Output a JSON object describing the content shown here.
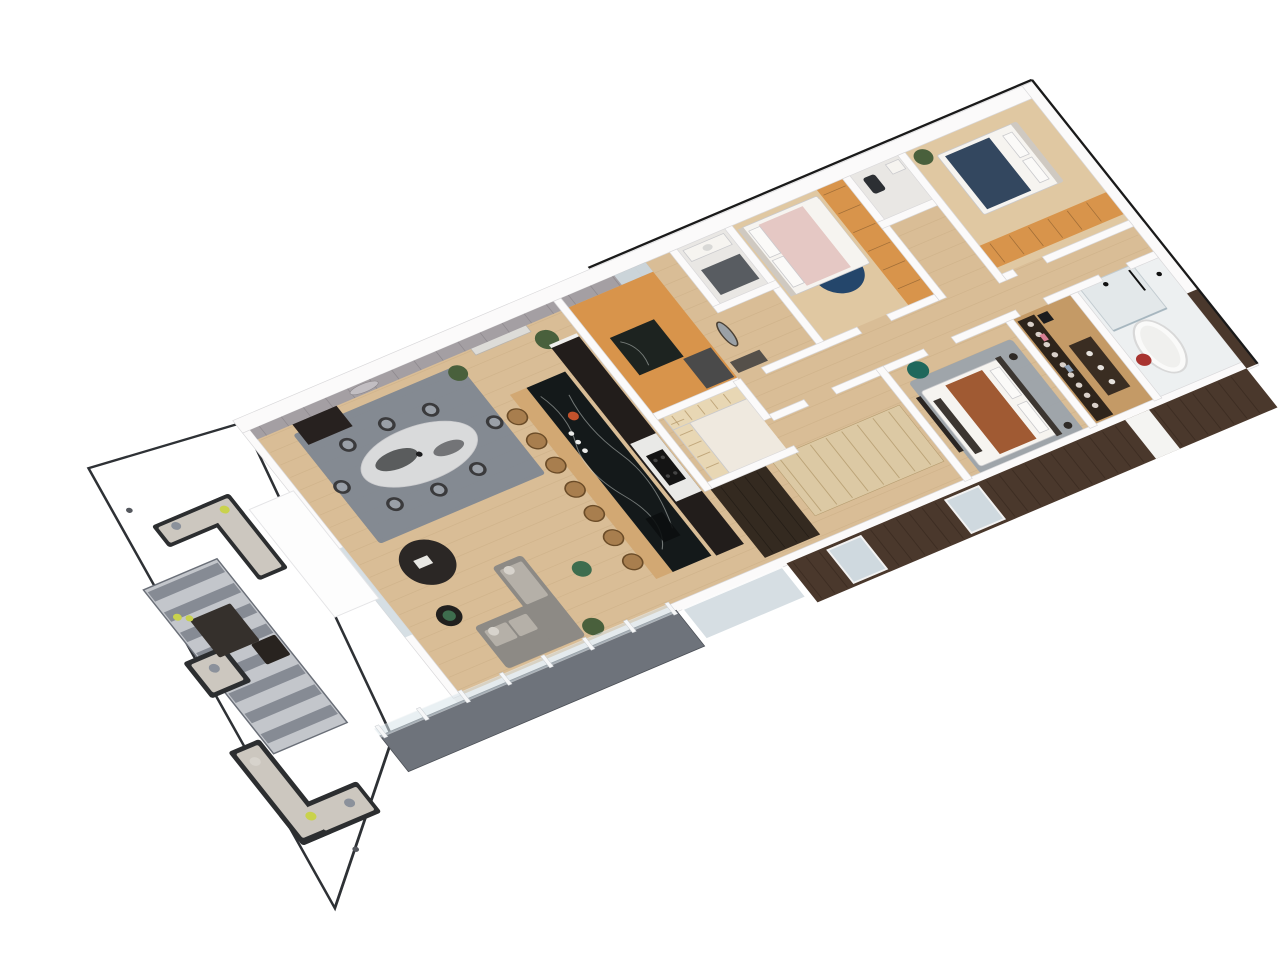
{
  "scene": {
    "type": "isometric-3d-floor-plan-render",
    "description": "Top-down isometric 3D render of a modern apartment: wrap-around gray terrace with outdoor lounge furniture at lower left, open-plan living/dining/kitchen with long black marble island, entry hall with orange cork floor, two bedrooms with orange wardrobes, two WCs, master bedroom, walk-in closet and bathroom with freestanding tub, dark wood facade along the lower-right edge",
    "background": "#ffffff"
  },
  "transform": {
    "matrix": [
      0.92,
      -0.39,
      0.62,
      0.78,
      250,
      430
    ]
  },
  "palette": {
    "bg": "#ffffff",
    "white": "#f4f3f2",
    "wall": "#fbfafa",
    "wallShade": "#d9d8da",
    "outline": "#1a1a1a",
    "grayWall": "#a49fa3",
    "panelSeam": "#6f6a70",
    "terrace": "#858a93",
    "terraceEdge": "#2e3135",
    "walkway": "#6e737b",
    "rugStripeLight": "#c3c6cb",
    "rugStripeDark": "#7f848e",
    "rugBorder": "#6a6f78",
    "diningRug": "#7d8591",
    "masterRug": "#9ca3ab",
    "navyRug": "#24466b",
    "wood": "#d9bd96",
    "woodLight": "#e0c8a2",
    "woodDark": "#c49a66",
    "plankLine": "#b99a6f",
    "orange": "#d8944b",
    "islandStone": "#14191a",
    "stoneVein": "#cfd6d2",
    "counterWood": "#d2a873",
    "stool": "#a87e4e",
    "stoolEdge": "#6b4c28",
    "kitchenDark": "#221d1b",
    "counterWhite": "#e9e9e7",
    "hob": "#141414",
    "facade": "#4a382c",
    "facadeSeam": "#2e2018",
    "glass": "#cfd9df",
    "glassRail": "#d8e4ea",
    "frameWhite": "#f6f7f8",
    "sofaGray": "#8d8a85",
    "sofaCushion": "#b5b0a8",
    "pillowLight": "#d7d3cc",
    "outdoorFrame": "#2c2e30",
    "outdoorCushion": "#ccc7bf",
    "lime": "#c9d24c",
    "grayPillow": "#8b919b",
    "tableDark": "#2b2725",
    "tableDark2": "#21201e",
    "greenAccent": "#3e6d4e",
    "plant": "#49603c",
    "marbleTop": "#d9dadb",
    "marbleDark": "#2f3133",
    "chairDark": "#3a3a3c",
    "chairSeat": "#9aa0a8",
    "cabinetDark": "#27211f",
    "bedWhite": "#f6f4f0",
    "bedPink": "#e5c8c4",
    "bedNavy": "#33475f",
    "bedRust": "#a05a33",
    "headboard": "#cfc9c1",
    "teal": "#20685c",
    "benchDark": "#3c3631",
    "closetDark": "#2e241b",
    "dresser": "#3a2d22",
    "bathFloor": "#edf0f1",
    "shower": "#e3e8ea",
    "tub": "#fafaf9",
    "tubEdge": "#d8d8d8",
    "red": "#a83430",
    "potOrange": "#c2522c",
    "wcFloor": "#e9e7e4",
    "mat": "#3e434a",
    "wardrobeLight": "#dcc9a4",
    "wardrobeSeam": "#b49b6e",
    "pantryShelf": "#e8d7b4",
    "darkWardrobe": "#342a20"
  },
  "rooms": [
    {
      "id": "terrace",
      "label": "Terrace"
    },
    {
      "id": "living-room",
      "label": "Living Room"
    },
    {
      "id": "dining-area",
      "label": "Dining Area"
    },
    {
      "id": "kitchen",
      "label": "Kitchen"
    },
    {
      "id": "entry-hall",
      "label": "Entry Hall"
    },
    {
      "id": "wc-1",
      "label": "WC 1"
    },
    {
      "id": "wc-2",
      "label": "WC 2"
    },
    {
      "id": "bedroom-2",
      "label": "Bedroom 2"
    },
    {
      "id": "bedroom-3",
      "label": "Bedroom 3"
    },
    {
      "id": "corridor",
      "label": "Corridor"
    },
    {
      "id": "pantry",
      "label": "Pantry"
    },
    {
      "id": "master-bedroom",
      "label": "Master Bedroom"
    },
    {
      "id": "walk-in-closet",
      "label": "Walk-in Closet"
    },
    {
      "id": "bathroom",
      "label": "Bathroom"
    },
    {
      "id": "balcony-walkway",
      "label": "Balcony Walkway"
    }
  ],
  "generated": [
    {
      "parent": "terrace-rug-stripes",
      "kind": "rect",
      "count": 8,
      "x": -188,
      "y": 114,
      "dy": 26,
      "w": 76,
      "h": 12,
      "fill": "--rugStripeDark",
      "op": 0.9
    },
    {
      "parent": "open-floor-planks",
      "kind": "line",
      "count": 21,
      "x": 2,
      "y": 14,
      "x2": 848,
      "dy": 16,
      "stroke": "--plankLine",
      "sw": 0.8,
      "op": 0.25
    },
    {
      "parent": "panel-seams",
      "kind": "line",
      "count": 18,
      "x": 10,
      "y": 0,
      "y2": 12,
      "dx": 24,
      "stroke": "--panelSeam",
      "sw": 0.8,
      "op": 0.4
    },
    {
      "parent": "island-stools",
      "kind": "circle",
      "count": 7,
      "x": 226,
      "y": 96,
      "dy": 31,
      "r": 9,
      "fill": "--stool",
      "stroke": "--stoolEdge",
      "sw": 1.5
    },
    {
      "parent": "island-plates",
      "kind": "circle",
      "count": 3,
      "x": 259,
      "y": 134,
      "dy": 11,
      "r": 2.6,
      "fill": "#ececea"
    },
    {
      "parent": "bar-bottles",
      "kind": "circle",
      "count": 5,
      "x": 44,
      "y": 10,
      "dx": 8,
      "r": 1.8,
      "fill": "#e9e7e1"
    },
    {
      "parent": "railing-posts",
      "kind": "rect",
      "count": 8,
      "x": -90,
      "y": 335,
      "dx": 45,
      "w": 4,
      "h": 15,
      "fill": "--frameWhite",
      "stroke": "#c8ccd0",
      "sw": 0.5
    },
    {
      "parent": "facade-seams",
      "kind": "line",
      "count": 35,
      "x": 356,
      "y": 348,
      "y2": 394,
      "dx": 14,
      "stroke": "--facadeSeam",
      "sw": 1,
      "op": 0.45
    },
    {
      "parent": "wardrobe-light-seams",
      "kind": "line",
      "count": 8,
      "x": 412,
      "y": 242,
      "y2": 310,
      "dx": 17,
      "stroke": "--wardrobeSeam",
      "sw": 1,
      "op": 0.8
    },
    {
      "parent": "wardrobe-dark-seams",
      "kind": "line",
      "count": 4,
      "x": 346,
      "y": 246,
      "y2": 330,
      "dx": 13,
      "stroke": "#000000",
      "sw": 0.8,
      "op": 0.3
    },
    {
      "parent": "bed2-wardrobe-seams",
      "kind": "line",
      "count": 6,
      "x": 618,
      "y": 8,
      "x2": 642,
      "dy": 24,
      "stroke": "#000000",
      "sw": 0.8,
      "op": 0.25
    },
    {
      "parent": "bed3-wardrobe-seams",
      "kind": "line",
      "count": 6,
      "x": 722,
      "y": 122,
      "y2": 146,
      "dx": 21,
      "stroke": "#000000",
      "sw": 0.8,
      "op": 0.25
    },
    {
      "parent": "closet-clothes",
      "kind": "circle",
      "count": 9,
      "x": 703,
      "y": 216,
      "dy": 13,
      "r": 3,
      "fill": "#d9d0c9"
    },
    {
      "parent": "pantry-shelf-lines-w",
      "kind": "line",
      "count": 5,
      "x": 346,
      "y": 166,
      "x2": 360,
      "dy": 14,
      "stroke": "#b79b6d",
      "sw": 1,
      "op": 0.8
    },
    {
      "parent": "pantry-shelf-lines-n",
      "kind": "line",
      "count": 5,
      "x": 352,
      "y": 158,
      "y2": 170,
      "dx": 14,
      "stroke": "#b79b6d",
      "sw": 1,
      "op": 0.8
    }
  ]
}
